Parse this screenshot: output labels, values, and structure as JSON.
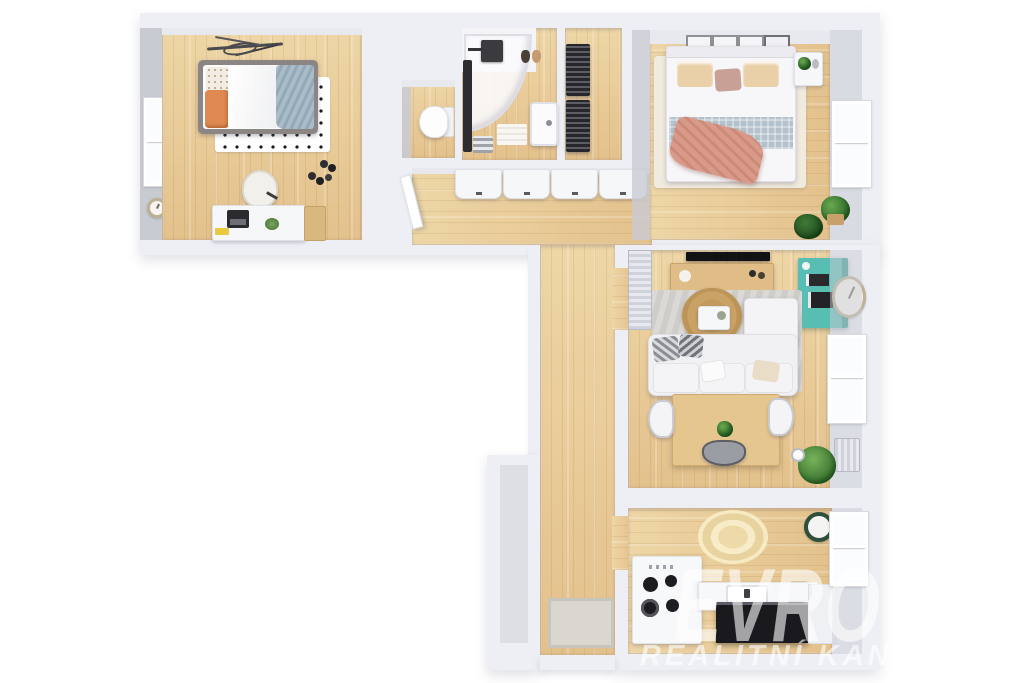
{
  "image_type": "3d-floor-plan-render",
  "watermark": {
    "brand": "EVRO",
    "subtitle": "REALITNÍ KAN",
    "color": "#ffffff",
    "opacity": 0.6
  },
  "palette": {
    "background": "#ffffff",
    "wall_outer": "#edeff4",
    "wall_inner_face": "#c9cbd3",
    "floor_wood_light": "#eed6a6",
    "floor_wood_dark": "#e3c18c",
    "accent_teal_cabinet": "#58bdb2",
    "kitchen_island_black": "#1a1a1e",
    "bed_throw_pink": "#d99a8a",
    "pillow_orange": "#e08a52",
    "blanket_blue_gray": "#a9bcc8",
    "rug_jute": "#c29a5e",
    "rug_gray": "#d8d6d3"
  },
  "scene": {
    "rooms": [
      {
        "id": "bedroom-small",
        "position": "top-left",
        "furniture": [
          "single-bed",
          "polka-dot-rug",
          "desk",
          "laptop",
          "desk-chair",
          "wall-branch-art",
          "dumbbells",
          "window",
          "wall-clock",
          "side-table"
        ]
      },
      {
        "id": "wc",
        "position": "top-middle-left",
        "furniture": [
          "toilet"
        ]
      },
      {
        "id": "bathroom",
        "position": "top-middle",
        "furniture": [
          "corner-shower",
          "shower-head",
          "tall-black-cabinet",
          "washbasin",
          "bath-mat",
          "towel-rack",
          "hanging-bags"
        ]
      },
      {
        "id": "storage-closet",
        "position": "top-middle-right",
        "furniture": [
          "metal-shelving-rack",
          "metal-shelving-rack"
        ]
      },
      {
        "id": "bedroom-master",
        "position": "top-right",
        "furniture": [
          "double-bed",
          "picture-frames",
          "cream-rug",
          "nightstand",
          "plant",
          "window",
          "potted-plants"
        ]
      },
      {
        "id": "living-room",
        "position": "middle-right",
        "furniture": [
          "tv",
          "tv-console",
          "teal-bookcase",
          "wall-clock",
          "gray-rug",
          "round-jute-rug",
          "coffee-table",
          "corner-sofa",
          "dining-table",
          "dining-chairs",
          "radiator",
          "potted-plant",
          "window"
        ]
      },
      {
        "id": "kitchen",
        "position": "bottom-right",
        "furniture": [
          "l-shaped-counter",
          "cooktop",
          "sink",
          "black-island-front",
          "fridge",
          "round-jute-rug",
          "wall-clock",
          "window"
        ]
      },
      {
        "id": "hallway",
        "position": "center",
        "furniture": [
          "built-in-wardrobes",
          "open-door",
          "doormat"
        ]
      }
    ]
  }
}
